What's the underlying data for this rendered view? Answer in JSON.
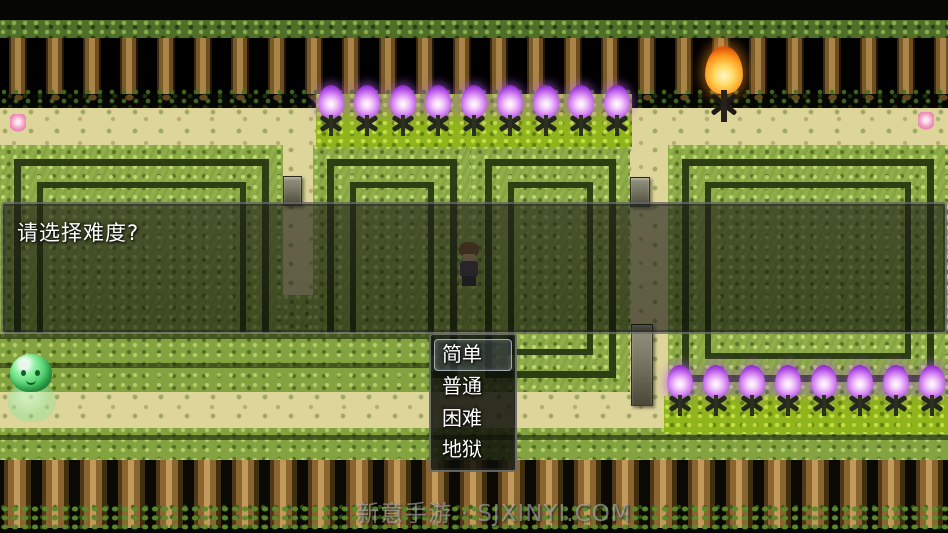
{
  "message_window": {
    "prompt": "请选择难度?"
  },
  "choice_window": {
    "items": [
      {
        "label": "简单",
        "selected": true
      },
      {
        "label": "普通",
        "selected": false
      },
      {
        "label": "困难",
        "selected": false
      },
      {
        "label": "地狱",
        "selected": false
      }
    ]
  },
  "watermark": {
    "text": "新意手游 · SJXINYI.COM"
  },
  "scene": {
    "torch_rows": {
      "top": {
        "count": 9
      },
      "bottom_right": {
        "count": 8
      }
    },
    "icons": [
      "purple-flame-torch-icon",
      "campfire-torch-icon",
      "green-slime",
      "hero-sprite"
    ],
    "palette": {
      "purple_flame": "#c86ae8",
      "orange_flame": "#ff9c20",
      "sand": "#ded59b",
      "hedge_bright": "#8fae48",
      "hedge_lime": "#8fb41c",
      "hedge_dark": "#283812",
      "trunk": "#8a6530",
      "selection_border": "#dce8ff"
    }
  }
}
